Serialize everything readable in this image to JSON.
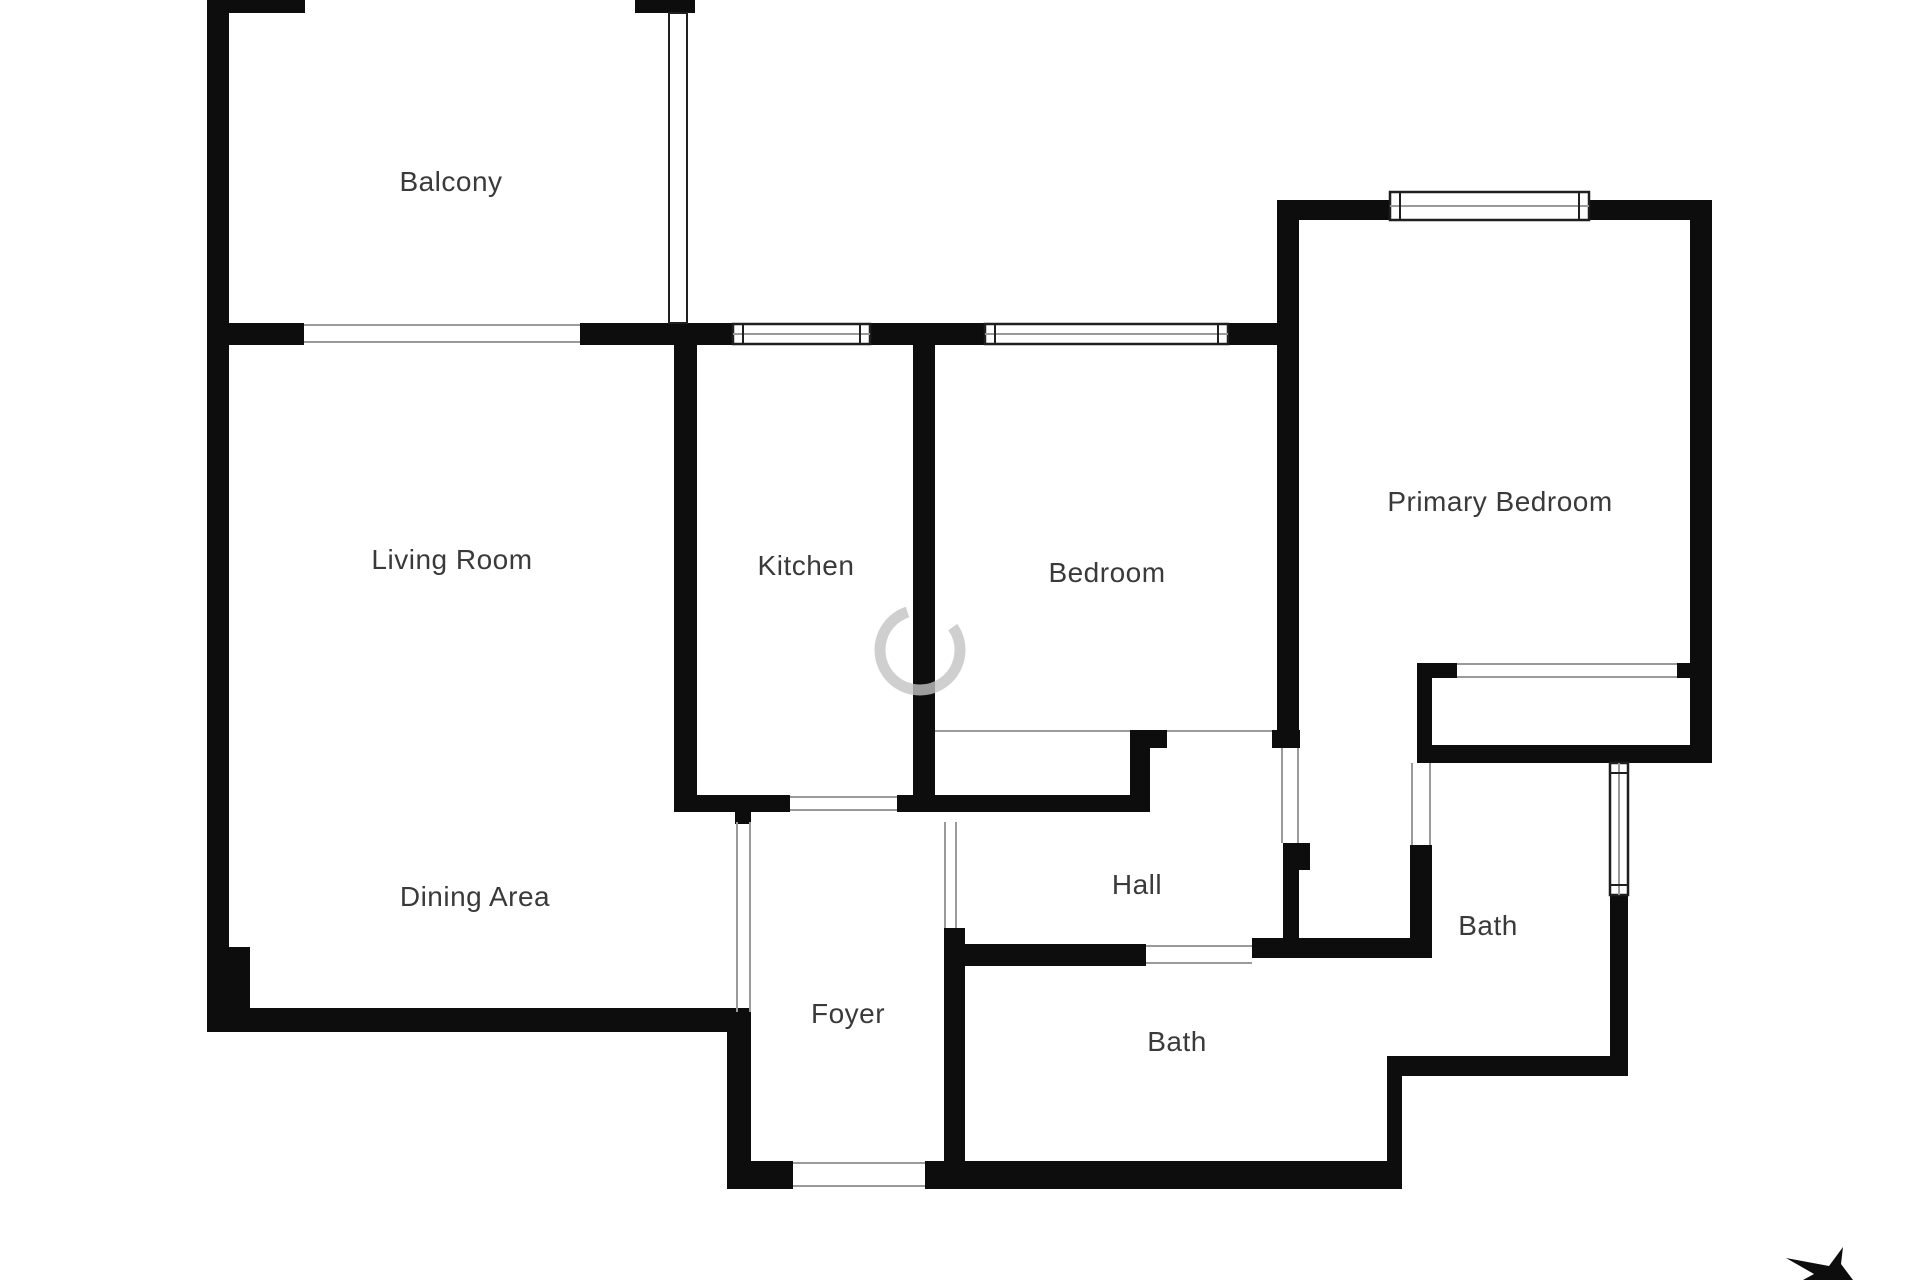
{
  "colors": {
    "wall": "#0d0d0d",
    "opening_line": "#9a9a9a",
    "window_stroke": "#1f1f1f",
    "window_fill": "#ffffff",
    "label": "#3a3a3a",
    "watermark": "rgba(195,195,195,0.8)",
    "background": "#ffffff"
  },
  "rooms": [
    {
      "id": "balcony",
      "label": "Balcony",
      "x": 451,
      "y": 182
    },
    {
      "id": "living-room",
      "label": "Living Room",
      "x": 452,
      "y": 560
    },
    {
      "id": "kitchen",
      "label": "Kitchen",
      "x": 806,
      "y": 566
    },
    {
      "id": "bedroom",
      "label": "Bedroom",
      "x": 1107,
      "y": 573
    },
    {
      "id": "primary-bedroom",
      "label": "Primary Bedroom",
      "x": 1500,
      "y": 502
    },
    {
      "id": "dining-area",
      "label": "Dining Area",
      "x": 475,
      "y": 897
    },
    {
      "id": "hall",
      "label": "Hall",
      "x": 1137,
      "y": 885
    },
    {
      "id": "foyer",
      "label": "Foyer",
      "x": 848,
      "y": 1014
    },
    {
      "id": "bath-center",
      "label": "Bath",
      "x": 1177,
      "y": 1042
    },
    {
      "id": "bath-right",
      "label": "Bath",
      "x": 1488,
      "y": 926
    }
  ],
  "geometry": {
    "walls": [
      [
        207,
        0,
        22,
        1032
      ],
      [
        207,
        947,
        43,
        85
      ],
      [
        207,
        0,
        98,
        13
      ],
      [
        635,
        0,
        60,
        13
      ],
      [
        207,
        323,
        97,
        22
      ],
      [
        580,
        323,
        153,
        22
      ],
      [
        870,
        323,
        115,
        22
      ],
      [
        1228,
        323,
        70,
        22
      ],
      [
        913,
        345,
        22,
        465
      ],
      [
        674,
        345,
        23,
        465
      ],
      [
        674,
        795,
        116,
        17
      ],
      [
        735,
        812,
        16,
        12
      ],
      [
        897,
        795,
        253,
        17
      ],
      [
        1130,
        748,
        20,
        47
      ],
      [
        1130,
        730,
        37,
        18
      ],
      [
        1272,
        730,
        28,
        18
      ],
      [
        1277,
        200,
        22,
        530
      ],
      [
        1283,
        843,
        16,
        113
      ],
      [
        1298,
        843,
        12,
        27
      ],
      [
        1277,
        200,
        113,
        20
      ],
      [
        1589,
        200,
        121,
        20
      ],
      [
        1690,
        200,
        22,
        563
      ],
      [
        1417,
        663,
        40,
        15
      ],
      [
        1677,
        663,
        20,
        15
      ],
      [
        1417,
        663,
        15,
        100
      ],
      [
        1432,
        745,
        280,
        18
      ],
      [
        1610,
        895,
        18,
        181
      ],
      [
        1387,
        1056,
        241,
        20
      ],
      [
        1387,
        1056,
        15,
        133
      ],
      [
        1410,
        845,
        22,
        111
      ],
      [
        1252,
        938,
        180,
        20
      ],
      [
        955,
        944,
        191,
        22
      ],
      [
        944,
        928,
        21,
        261
      ],
      [
        740,
        1161,
        53,
        28
      ],
      [
        925,
        1161,
        477,
        28
      ],
      [
        727,
        1012,
        24,
        177
      ],
      [
        207,
        1008,
        544,
        24
      ]
    ],
    "windows": [
      {
        "x": 733,
        "y": 324,
        "w": 137,
        "h": 20,
        "orient": "h"
      },
      {
        "x": 985,
        "y": 324,
        "w": 243,
        "h": 20,
        "orient": "h"
      },
      {
        "x": 1390,
        "y": 192,
        "w": 199,
        "h": 28,
        "orient": "h"
      },
      {
        "x": 1610,
        "y": 763,
        "w": 18,
        "h": 132,
        "orient": "v"
      }
    ],
    "glass_walls": [
      {
        "x": 669,
        "y": 13,
        "w": 18,
        "h": 310
      }
    ],
    "opening_lines": [
      [
        304,
        325,
        580,
        325
      ],
      [
        304,
        342,
        580,
        342
      ],
      [
        790,
        797,
        897,
        797
      ],
      [
        790,
        810,
        897,
        810
      ],
      [
        935,
        731,
        1130,
        731
      ],
      [
        1167,
        731,
        1272,
        731
      ],
      [
        1457,
        664,
        1677,
        664
      ],
      [
        1457,
        677,
        1677,
        677
      ],
      [
        1282,
        748,
        1282,
        843
      ],
      [
        1298,
        748,
        1298,
        843
      ],
      [
        737,
        822,
        737,
        1012
      ],
      [
        750,
        822,
        750,
        1012
      ],
      [
        945,
        822,
        945,
        928
      ],
      [
        956,
        822,
        956,
        928
      ],
      [
        1412,
        763,
        1412,
        845
      ],
      [
        1430,
        763,
        1430,
        845
      ],
      [
        1146,
        946,
        1252,
        946
      ],
      [
        1146,
        963,
        1252,
        963
      ],
      [
        793,
        1163,
        925,
        1163
      ],
      [
        793,
        1186,
        925,
        1186
      ]
    ]
  },
  "watermark": {
    "cx": 920,
    "cy": 650,
    "r": 40,
    "stroke_width": 11
  },
  "compass_arrow": {
    "path": "M1843,1247 L1829,1266 L1786,1258 L1814,1274 L1803,1280 L1853,1280 L1841,1264 Z"
  }
}
